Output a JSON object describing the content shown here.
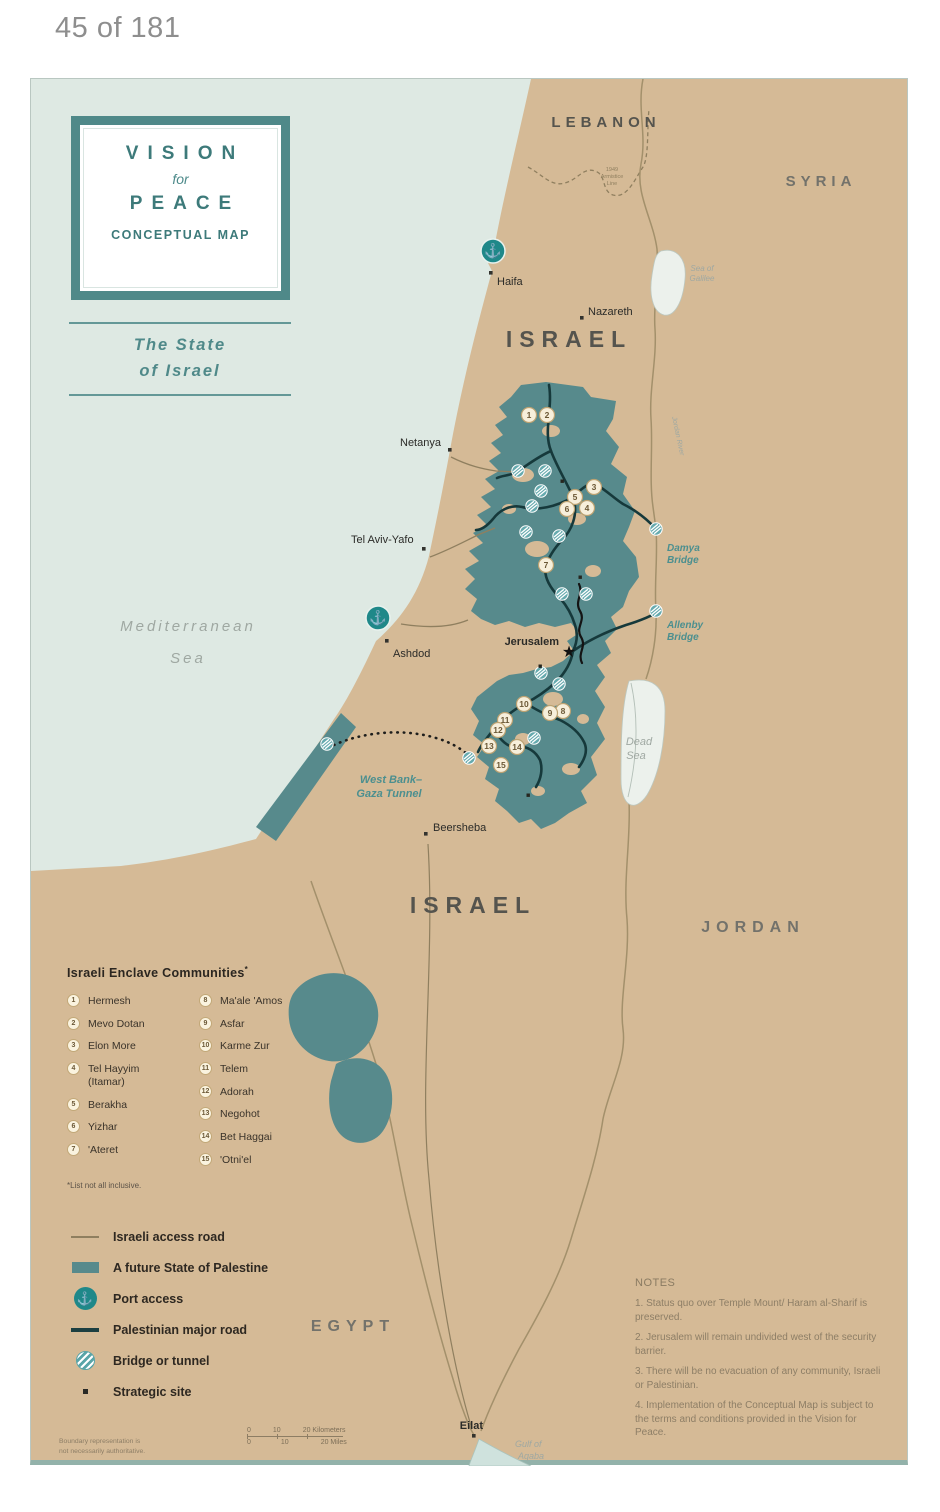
{
  "page": {
    "indicator": "45 of 181"
  },
  "title_box": {
    "vision": "VISION",
    "for_word": "for",
    "peace": "PEACE",
    "subtitle": "CONCEPTUAL MAP"
  },
  "state_label": {
    "line1": "The State",
    "line2": "of Israel"
  },
  "map": {
    "countries": {
      "lebanon": "LEBANON",
      "syria": "SYRIA",
      "israel_north": "ISRAEL",
      "israel_south": "ISRAEL",
      "jordan": "JORDAN",
      "egypt": "EGYPT"
    },
    "cities": {
      "haifa": "Haifa",
      "nazareth": "Nazareth",
      "netanya": "Netanya",
      "tel_aviv": "Tel Aviv-Yafo",
      "ashdod": "Ashdod",
      "jerusalem": "Jerusalem",
      "beersheba": "Beersheba",
      "eilat": "Eilat"
    },
    "water": {
      "mediterranean1": "Mediterranean",
      "mediterranean2": "Sea",
      "galilee1": "Sea of",
      "galilee2": "Galilee",
      "dead1": "Dead",
      "dead2": "Sea",
      "aqaba1": "Gulf of",
      "aqaba2": "Aqaba",
      "jordan_river": "Jordan River"
    },
    "labels": {
      "damya1": "Damya",
      "damya2": "Bridge",
      "allenby1": "Allenby",
      "allenby2": "Bridge",
      "tunnel1": "West Bank–",
      "tunnel2": "Gaza Tunnel",
      "armistice1": "1949",
      "armistice2": "Armistice",
      "armistice3": "Line"
    },
    "markers": [
      "1",
      "2",
      "3",
      "4",
      "5",
      "6",
      "7",
      "8",
      "9",
      "10",
      "11",
      "12",
      "13",
      "14",
      "15"
    ]
  },
  "enclaves": {
    "title": "Israeli Enclave Communities",
    "asterisk": "*",
    "items": [
      {
        "n": "1",
        "name": "Hermesh"
      },
      {
        "n": "2",
        "name": "Mevo Dotan"
      },
      {
        "n": "3",
        "name": "Elon More"
      },
      {
        "n": "4",
        "name": "Tel Hayyim",
        "name2": "(Itamar)"
      },
      {
        "n": "5",
        "name": "Berakha"
      },
      {
        "n": "6",
        "name": "Yizhar"
      },
      {
        "n": "7",
        "name": "'Ateret"
      },
      {
        "n": "8",
        "name": "Ma'ale 'Amos"
      },
      {
        "n": "9",
        "name": "Asfar"
      },
      {
        "n": "10",
        "name": "Karme Zur"
      },
      {
        "n": "11",
        "name": "Telem"
      },
      {
        "n": "12",
        "name": "Adorah"
      },
      {
        "n": "13",
        "name": "Negohot"
      },
      {
        "n": "14",
        "name": "Bet Haggai"
      },
      {
        "n": "15",
        "name": "'Otni'el"
      }
    ],
    "footnote": "*List not all inclusive."
  },
  "map_legend": {
    "access_road": "Israeli access road",
    "palestine": "A future State of Palestine",
    "port": "Port access",
    "major_road": "Palestinian major road",
    "bridge": "Bridge or tunnel",
    "strategic": "Strategic site"
  },
  "notes": {
    "title": "NOTES",
    "items": [
      "1. Status quo over Temple Mount/ Haram al-Sharif is preserved.",
      "2. Jerusalem will remain undivided west of the security barrier.",
      "3. There will be no evacuation of any community, Israeli or Palestinian.",
      "4. Implementation of the Conceptual Map is subject to the terms and conditions provided in the Vision for Peace."
    ]
  },
  "scale": {
    "k0": "0",
    "k10": "10",
    "k20": "20 Kilometers",
    "m0": "0",
    "m10": "10",
    "m20": "20 Miles"
  },
  "disclaimer": {
    "line1": "Boundary representation is",
    "line2": "not necessarily authoritative."
  },
  "colors": {
    "palestine_teal": "#578a8c",
    "land_tan": "#d5ba96",
    "sea": "#dee9e3",
    "title_teal": "#3d7a7a",
    "port_teal": "#1f8889",
    "major_road": "#1c3f41",
    "access_road": "#8f7f5f",
    "notes_text": "#8d7e66"
  }
}
